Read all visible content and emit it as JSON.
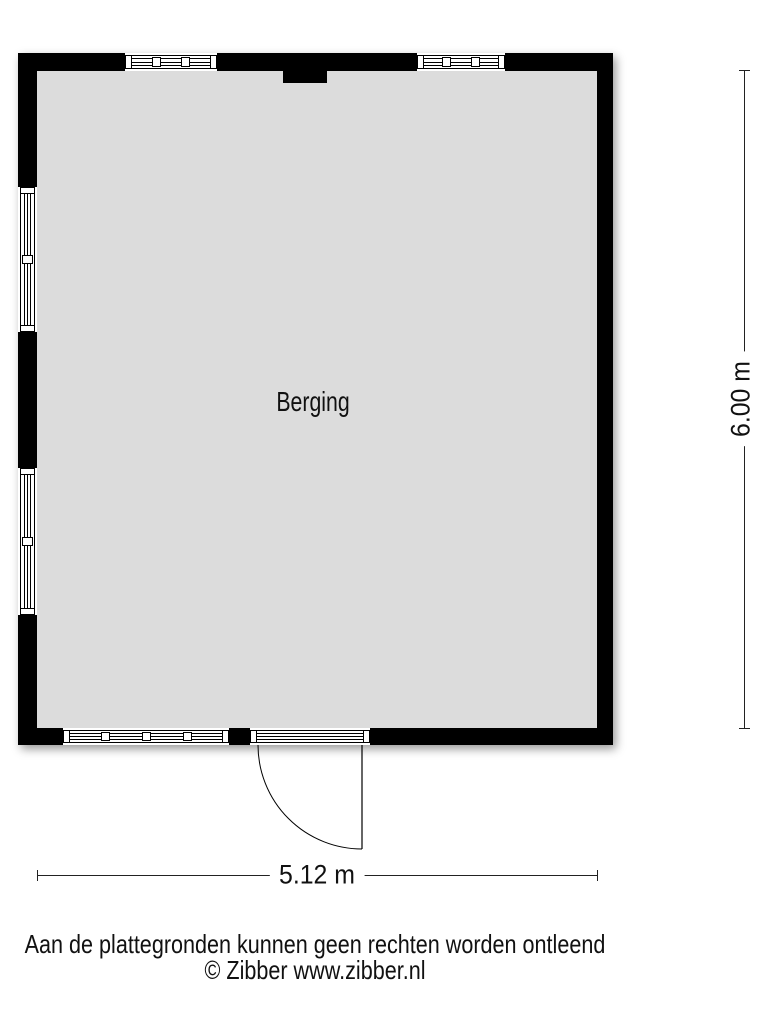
{
  "floor_plan": {
    "room_label": "Berging",
    "dimensions": {
      "width_label": "5.12 m",
      "height_label": "6.00 m"
    },
    "disclaimer_line1": "Aan de plattegronden kunnen geen rechten worden ontleend",
    "disclaimer_line2": "© Zibber www.zibber.nl",
    "colors": {
      "wall": "#000000",
      "floor": "#dcdcdc",
      "background": "#ffffff"
    }
  }
}
